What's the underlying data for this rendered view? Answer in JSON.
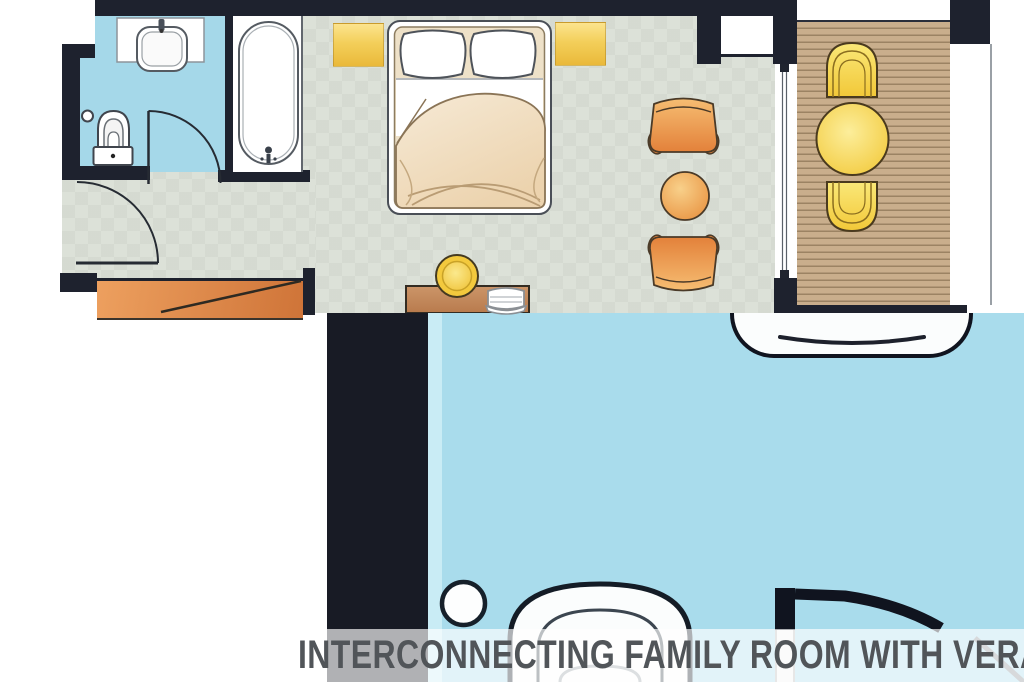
{
  "title": {
    "label": "INTERCONNECTING FAMILY ROOM WITH VERANDA"
  },
  "palette": {
    "wall": "#1e222e",
    "wall2": "#181b25",
    "bath": "#a5d8e9",
    "floor": "#dce1d8",
    "deck": "#c9ae8c",
    "pool": "#a9dcec",
    "band": "rgba(255,255,255,0.66)",
    "title": "#515559",
    "accent_yellow": "#f2c838",
    "accent_orange": "#e8913f",
    "wood_brown": "#bf8757"
  },
  "plans": {
    "main_room": {
      "zones": [
        "bathroom",
        "bedroom",
        "sitting-area",
        "veranda"
      ],
      "fixtures": [
        "washbasin",
        "bathtub",
        "toilet",
        "double-bed",
        "nightstand-left",
        "nightstand-right",
        "armchair-top",
        "side-table",
        "armchair-bottom",
        "desk",
        "stool",
        "desk-chair",
        "wardrobe",
        "sliding-door",
        "entry-door",
        "bathroom-door",
        "veranda-chair-top",
        "veranda-table",
        "veranda-chair-bottom"
      ]
    },
    "interconnecting_room_closeup": {
      "fixtures": [
        "bathtub-edge",
        "toilet",
        "spotlight-circle",
        "door-with-swing"
      ]
    }
  }
}
